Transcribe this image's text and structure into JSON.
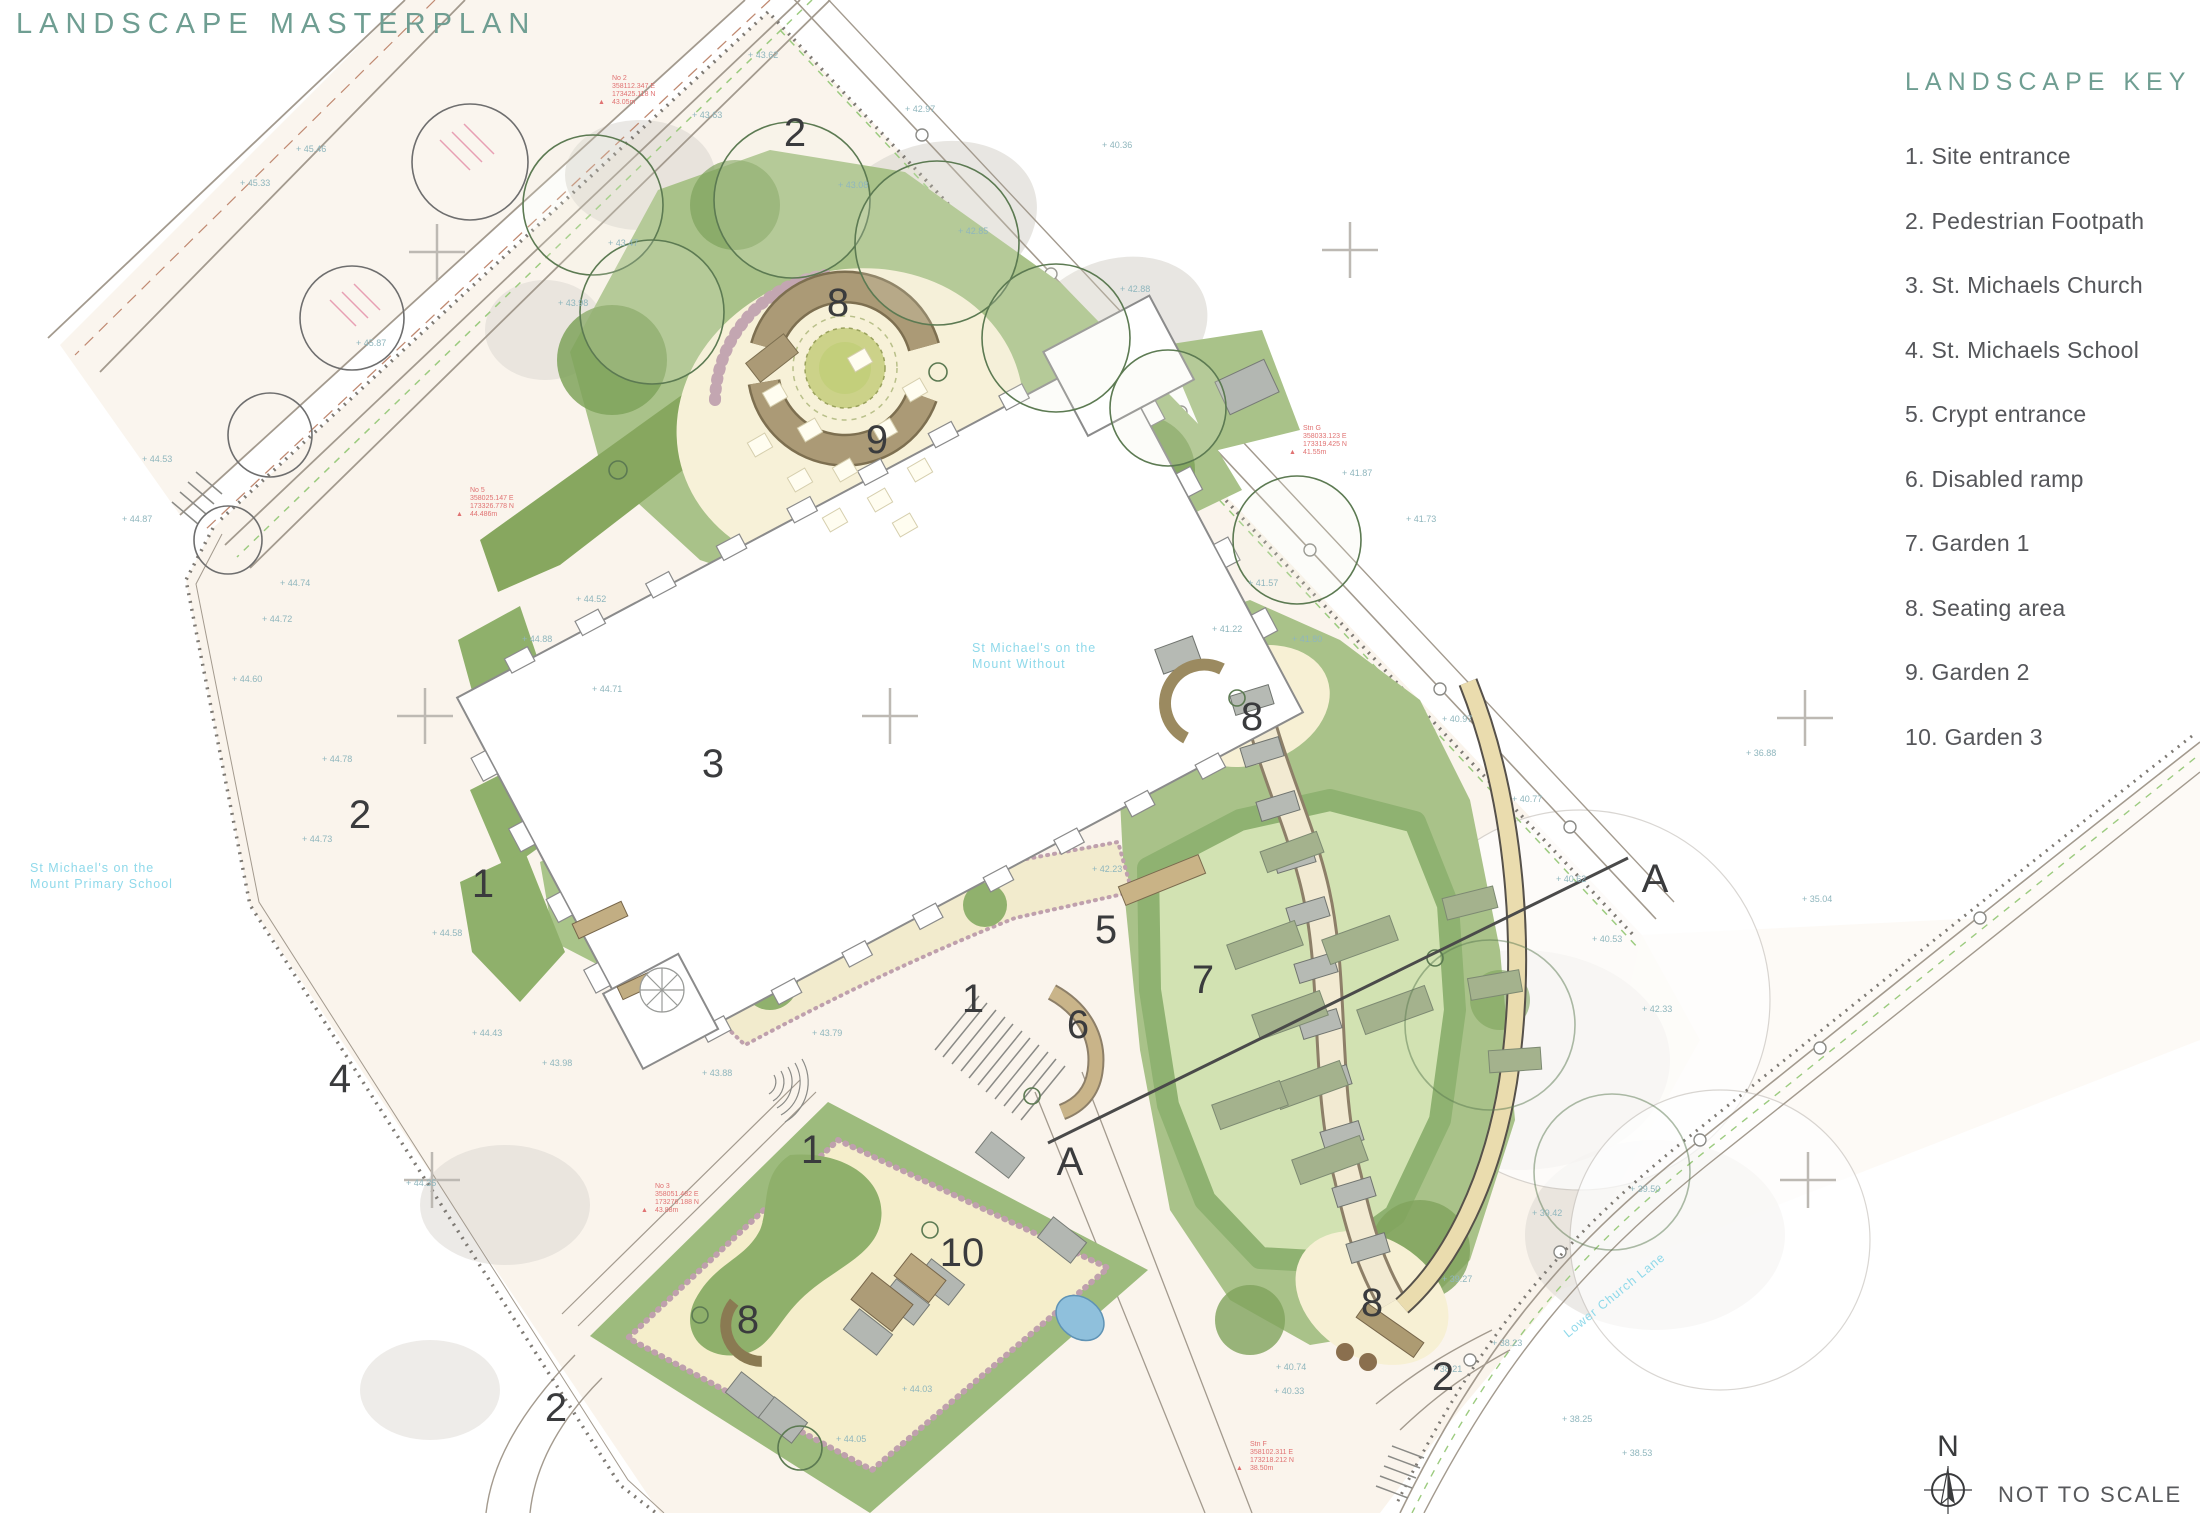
{
  "title": "LANDSCAPE MASTERPLAN",
  "key": {
    "title": "LANDSCAPE KEY",
    "items": [
      {
        "num": "1.",
        "label": "Site entrance"
      },
      {
        "num": "2.",
        "label": "Pedestrian Footpath"
      },
      {
        "num": "3.",
        "label": "St. Michaels Church"
      },
      {
        "num": "4.",
        "label": "St. Michaels School"
      },
      {
        "num": "5.",
        "label": "Crypt entrance"
      },
      {
        "num": "6.",
        "label": "Disabled ramp"
      },
      {
        "num": "7.",
        "label": "Garden 1"
      },
      {
        "num": "8.",
        "label": "Seating area"
      },
      {
        "num": "9.",
        "label": "Garden 2"
      },
      {
        "num": "10.",
        "label": "Garden 3"
      }
    ]
  },
  "north_label": "N",
  "scale_note": "NOT TO SCALE",
  "colors": {
    "accent_teal": "#6f9e92",
    "key_text": "#55565a",
    "label_dark": "#3a3b3d",
    "cyan_note": "#8fd9ea",
    "survey_red": "#e07272"
  },
  "plan": {
    "number_labels": [
      {
        "t": "2",
        "x": 795,
        "y": 146
      },
      {
        "t": "8",
        "x": 838,
        "y": 316
      },
      {
        "t": "9",
        "x": 877,
        "y": 453
      },
      {
        "t": "3",
        "x": 713,
        "y": 777
      },
      {
        "t": "2",
        "x": 360,
        "y": 828
      },
      {
        "t": "1",
        "x": 483,
        "y": 897
      },
      {
        "t": "4",
        "x": 340,
        "y": 1092
      },
      {
        "t": "1",
        "x": 973,
        "y": 1012
      },
      {
        "t": "5",
        "x": 1106,
        "y": 943
      },
      {
        "t": "6",
        "x": 1078,
        "y": 1038
      },
      {
        "t": "7",
        "x": 1203,
        "y": 993
      },
      {
        "t": "10",
        "x": 962,
        "y": 1266
      },
      {
        "t": "8",
        "x": 748,
        "y": 1333
      },
      {
        "t": "1",
        "x": 812,
        "y": 1163
      },
      {
        "t": "2",
        "x": 556,
        "y": 1421
      },
      {
        "t": "8",
        "x": 1372,
        "y": 1316
      },
      {
        "t": "2",
        "x": 1443,
        "y": 1390
      },
      {
        "t": "8",
        "x": 1252,
        "y": 730
      }
    ],
    "section_labels": [
      {
        "t": "A",
        "x": 1655,
        "y": 892
      },
      {
        "t": "A",
        "x": 1070,
        "y": 1175
      }
    ],
    "place_texts": [
      {
        "lines": [
          "St Michael's on the",
          "Mount Without"
        ],
        "x": 972,
        "y": 652,
        "rot": 0
      },
      {
        "lines": [
          "St Michael's on the",
          "Mount Primary School"
        ],
        "x": 30,
        "y": 872,
        "rot": 0
      },
      {
        "lines": [
          "Lower Church Lane"
        ],
        "x": 1568,
        "y": 1338,
        "rot": -39
      }
    ],
    "survey_notes": [
      {
        "lines": [
          "No 2",
          "358112.347 E",
          "173425.118 N",
          "43.05m"
        ],
        "x": 612,
        "y": 80
      },
      {
        "lines": [
          "Stn G",
          "358033.123 E",
          "173319.425 N",
          "41.55m"
        ],
        "x": 1303,
        "y": 430
      },
      {
        "lines": [
          "No 5",
          "358025.147 E",
          "173326.778 N",
          "44.486m"
        ],
        "x": 470,
        "y": 492
      },
      {
        "lines": [
          "No 3",
          "358051.482 E",
          "173276.188 N",
          "43.88m"
        ],
        "x": 655,
        "y": 1188
      },
      {
        "lines": [
          "Stn F",
          "358102.311 E",
          "173218.212 N",
          "38.50m"
        ],
        "x": 1250,
        "y": 1446
      }
    ],
    "spot_heights": [
      {
        "v": "43.62",
        "x": 748,
        "y": 58
      },
      {
        "v": "43.63",
        "x": 692,
        "y": 118
      },
      {
        "v": "42.97",
        "x": 905,
        "y": 112
      },
      {
        "v": "40.36",
        "x": 1102,
        "y": 148
      },
      {
        "v": "43.08",
        "x": 838,
        "y": 188
      },
      {
        "v": "42.85",
        "x": 958,
        "y": 234
      },
      {
        "v": "42.88",
        "x": 1120,
        "y": 292
      },
      {
        "v": "43.47",
        "x": 608,
        "y": 246
      },
      {
        "v": "43.98",
        "x": 558,
        "y": 306
      },
      {
        "v": "45.46",
        "x": 296,
        "y": 152
      },
      {
        "v": "45.33",
        "x": 240,
        "y": 186
      },
      {
        "v": "45.87",
        "x": 356,
        "y": 346
      },
      {
        "v": "44.53",
        "x": 142,
        "y": 462
      },
      {
        "v": "44.87",
        "x": 122,
        "y": 522
      },
      {
        "v": "44.74",
        "x": 280,
        "y": 586
      },
      {
        "v": "44.72",
        "x": 262,
        "y": 622
      },
      {
        "v": "44.60",
        "x": 232,
        "y": 682
      },
      {
        "v": "44.78",
        "x": 322,
        "y": 762
      },
      {
        "v": "44.73",
        "x": 302,
        "y": 842
      },
      {
        "v": "44.58",
        "x": 432,
        "y": 936
      },
      {
        "v": "44.43",
        "x": 472,
        "y": 1036
      },
      {
        "v": "44.35",
        "x": 406,
        "y": 1186
      },
      {
        "v": "43.98",
        "x": 542,
        "y": 1066
      },
      {
        "v": "44.88",
        "x": 522,
        "y": 642
      },
      {
        "v": "44.71",
        "x": 592,
        "y": 692
      },
      {
        "v": "44.52",
        "x": 576,
        "y": 602
      },
      {
        "v": "43.88",
        "x": 702,
        "y": 1076
      },
      {
        "v": "43.79",
        "x": 812,
        "y": 1036
      },
      {
        "v": "41.87",
        "x": 1342,
        "y": 476
      },
      {
        "v": "41.73",
        "x": 1406,
        "y": 522
      },
      {
        "v": "41.80",
        "x": 1292,
        "y": 642
      },
      {
        "v": "40.97",
        "x": 1442,
        "y": 722
      },
      {
        "v": "40.77",
        "x": 1512,
        "y": 802
      },
      {
        "v": "40.62",
        "x": 1556,
        "y": 882
      },
      {
        "v": "40.53",
        "x": 1592,
        "y": 942
      },
      {
        "v": "42.33",
        "x": 1642,
        "y": 1012
      },
      {
        "v": "36.88",
        "x": 1746,
        "y": 756
      },
      {
        "v": "35.04",
        "x": 1802,
        "y": 902
      },
      {
        "v": "39.42",
        "x": 1532,
        "y": 1216
      },
      {
        "v": "39.27",
        "x": 1442,
        "y": 1282
      },
      {
        "v": "38.23",
        "x": 1492,
        "y": 1346
      },
      {
        "v": "38.21",
        "x": 1432,
        "y": 1372
      },
      {
        "v": "38.25",
        "x": 1562,
        "y": 1422
      },
      {
        "v": "38.53",
        "x": 1622,
        "y": 1456
      },
      {
        "v": "40.74",
        "x": 1276,
        "y": 1370
      },
      {
        "v": "40.33",
        "x": 1274,
        "y": 1394
      },
      {
        "v": "44.03",
        "x": 902,
        "y": 1392
      },
      {
        "v": "44.05",
        "x": 836,
        "y": 1442
      },
      {
        "v": "41.22",
        "x": 1212,
        "y": 632
      },
      {
        "v": "41.57",
        "x": 1248,
        "y": 586
      },
      {
        "v": "42.23",
        "x": 1092,
        "y": 872
      },
      {
        "v": "39.50",
        "x": 1630,
        "y": 1192
      }
    ]
  }
}
